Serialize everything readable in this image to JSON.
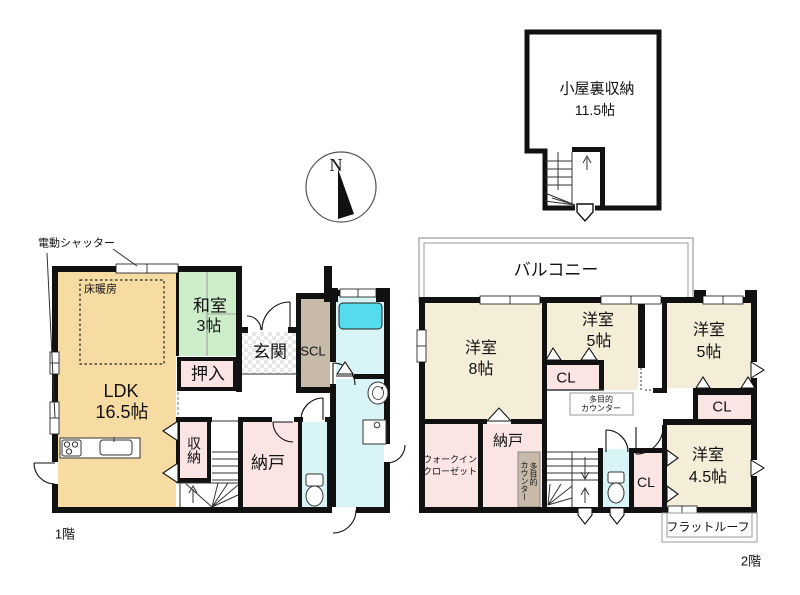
{
  "colors": {
    "wall": "#111111",
    "ldk_tan": "#F6DCA2",
    "tatami_green": "#CDEDCB",
    "room_pink": "#FAE4E4",
    "room_cream": "#F4EDD8",
    "wet_cyan": "#D8F4F6",
    "bathtub_cyan": "#55DCEC",
    "closet_brown": "#C8BAA9",
    "tile_gray": "#E8E8E8"
  },
  "compass": {
    "north": "N"
  },
  "annotations": {
    "shutter": "電動シャッター"
  },
  "attic": {
    "name": "小屋裏収納",
    "size": "11.5帖"
  },
  "floor1": {
    "label": "1階",
    "ldk": {
      "name": "LDK",
      "size": "16.5帖"
    },
    "floor_heating": "床暖房",
    "washitsu": {
      "name": "和室",
      "size": "3帖"
    },
    "oshiire": "押入",
    "genkan": "玄関",
    "scl": "SCL",
    "storage": "収納",
    "nando": "納戸"
  },
  "floor2": {
    "label": "2階",
    "balcony": "バルコニー",
    "room8": {
      "name": "洋室",
      "size": "8帖"
    },
    "room5_center": {
      "name": "洋室",
      "size": "5帖"
    },
    "room5_right": {
      "name": "洋室",
      "size": "5帖"
    },
    "room45": {
      "name": "洋室",
      "size": "4.5帖"
    },
    "cl_center": "CL",
    "cl_right": "CL",
    "cl_small": "CL",
    "wic": {
      "line1": "ウォークイン",
      "line2": "クローゼット"
    },
    "nando": "納戸",
    "counter_box": {
      "line1": "多目的",
      "line2": "カウンター"
    },
    "counter_strip": {
      "line1": "多目的",
      "line2": "カウンター"
    },
    "flat_roof": "フラットルーフ"
  }
}
